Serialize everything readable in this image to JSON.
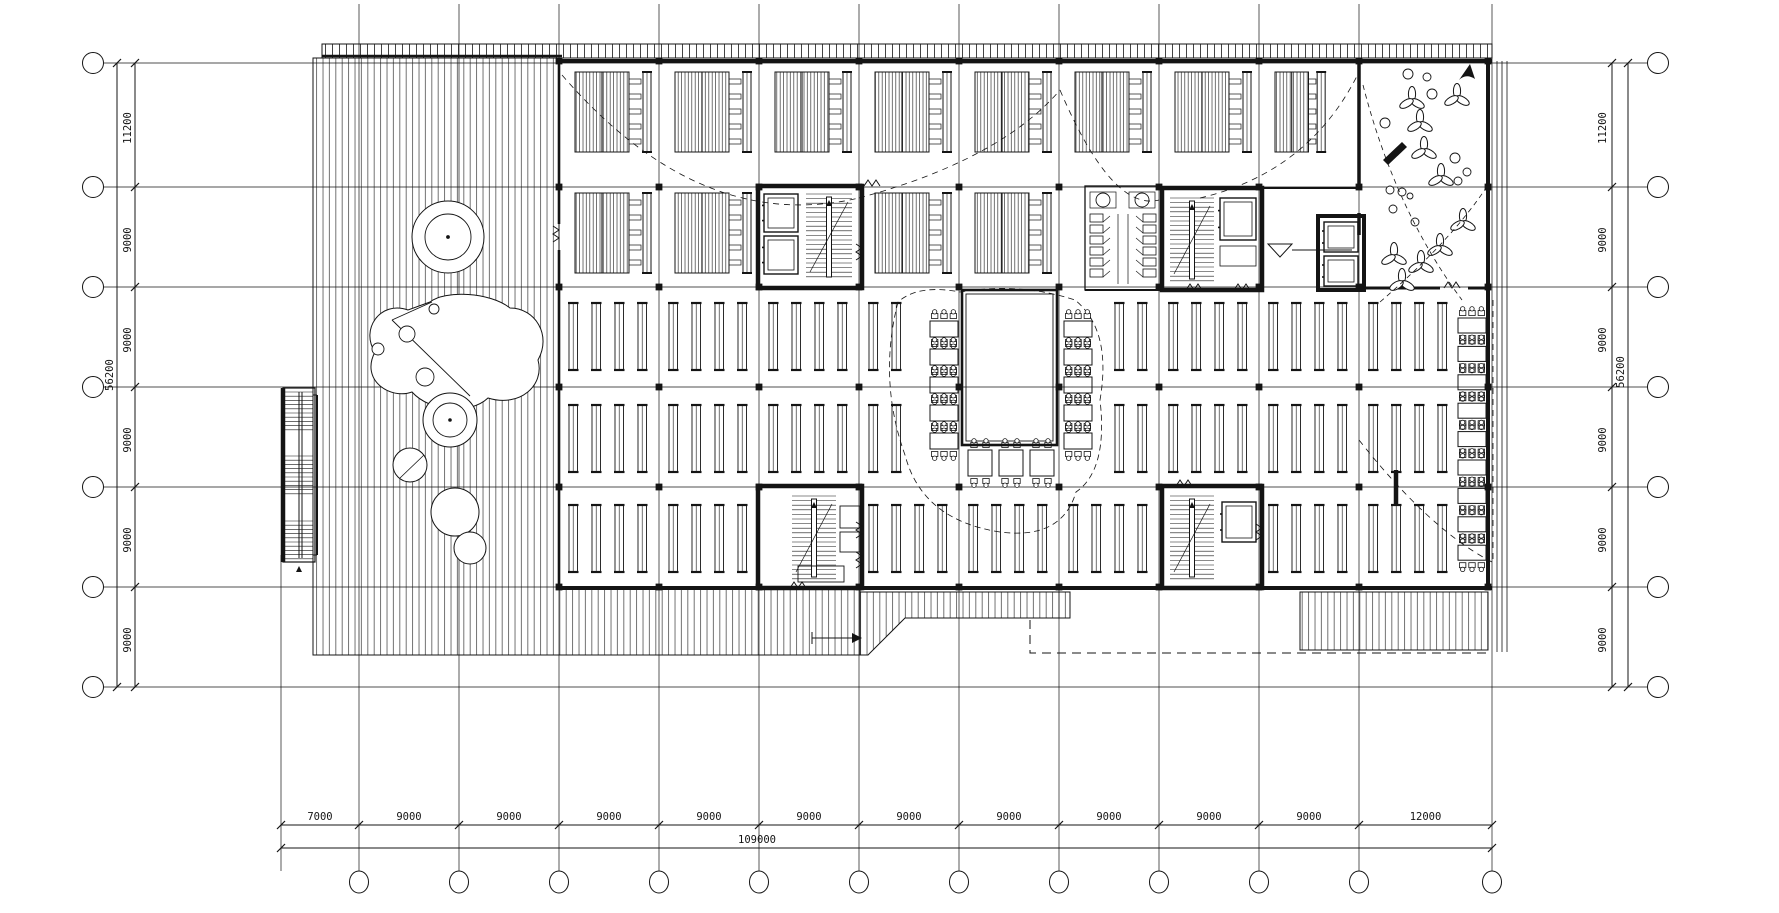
{
  "drawing": {
    "type": "architectural-floor-plan",
    "units": "mm",
    "sheet": {
      "width": 1779,
      "height": 913
    }
  },
  "palette": {
    "ink": "#141414",
    "paper": "#ffffff"
  },
  "grid": {
    "verticals_x": [
      281,
      359,
      459,
      559,
      659,
      759,
      859,
      959,
      1059,
      1159,
      1259,
      1359,
      1492
    ],
    "horizontals_y": [
      63,
      187,
      287,
      387,
      487,
      587,
      687
    ],
    "bubbled_verticals_from_index": 1
  },
  "dimensions": {
    "left": {
      "segments": [
        "11200",
        "9000",
        "9000",
        "9000",
        "9000",
        "9000"
      ],
      "total": "56200"
    },
    "right": {
      "segments": [
        "11200",
        "9000",
        "9000",
        "9000",
        "9000",
        "9000"
      ],
      "total": "56200"
    },
    "bottom": {
      "segments": [
        "7000",
        "9000",
        "9000",
        "9000",
        "9000",
        "9000",
        "9000",
        "9000",
        "9000",
        "9000",
        "9000",
        "12000"
      ],
      "total": "109000"
    }
  },
  "legend": {
    "deck_terrace": "striped decking",
    "canopy_band": "ladder hatch strip",
    "atrium": "double-line void",
    "courtyard": "planted garden"
  }
}
